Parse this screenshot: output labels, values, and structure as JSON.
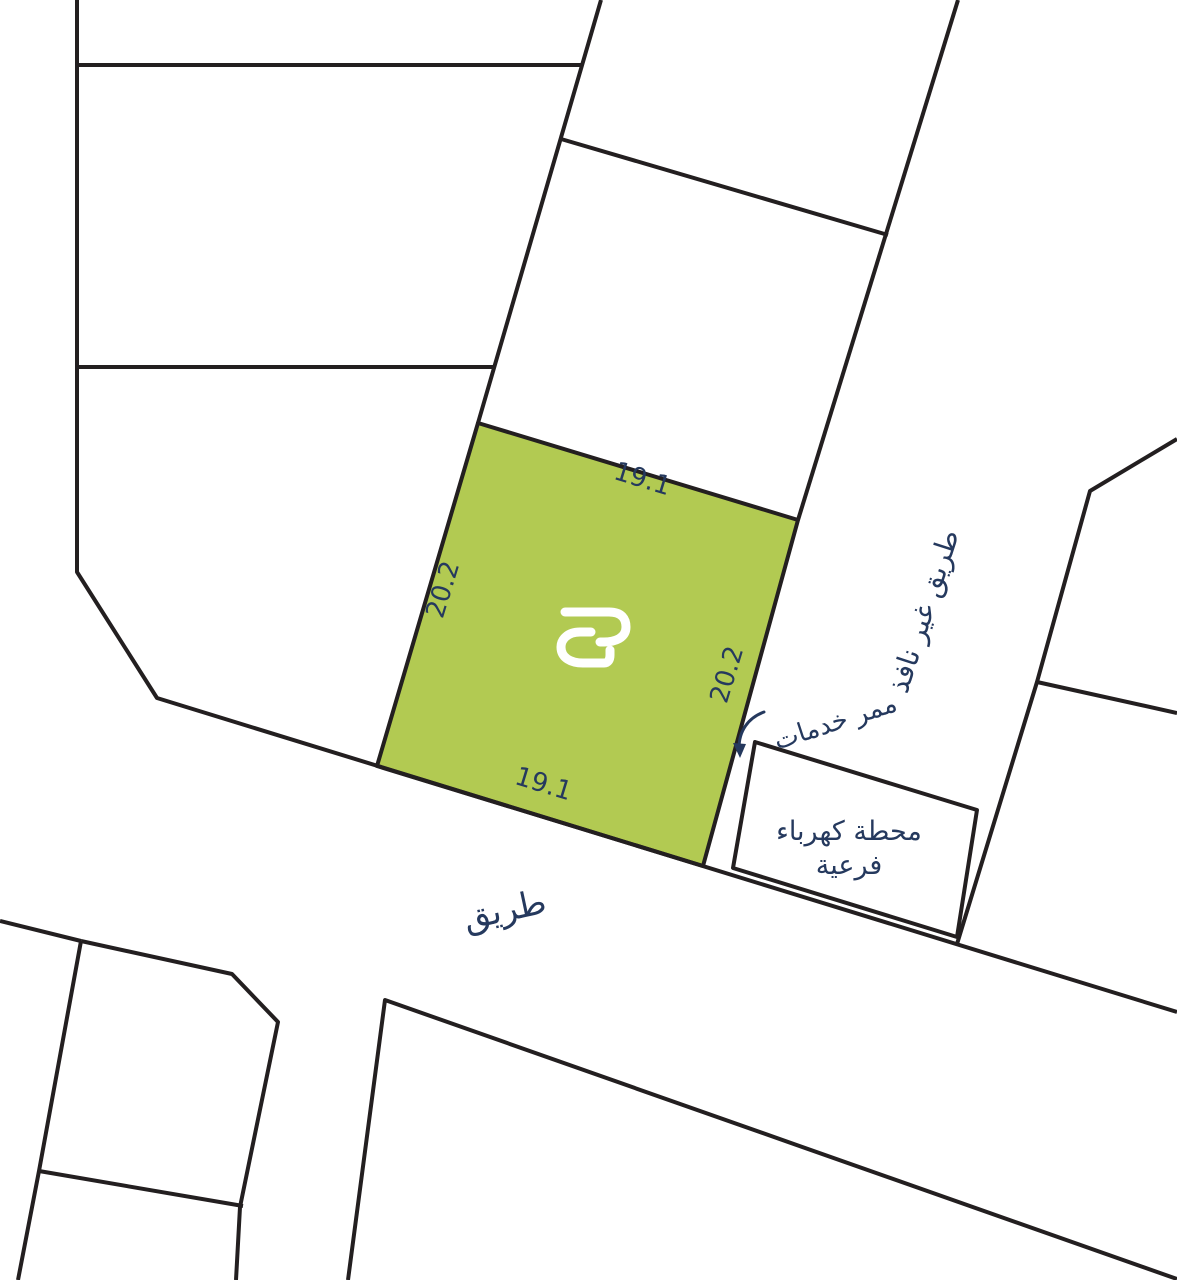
{
  "map": {
    "colors": {
      "background": "#ffffff",
      "line": "#231f20",
      "text": "#25395e",
      "plot_fill": "#b2ca52",
      "logo": "#ffffff"
    },
    "plot": {
      "dim_top": "19.1",
      "dim_bottom": "19.1",
      "dim_left": "20.2",
      "dim_right": "20.2"
    },
    "labels": {
      "road": "طريق",
      "dead_end_road": "طريق غير نافذ",
      "service_corridor": "ممر خدمات",
      "substation_line1": "محطة كهرباء",
      "substation_line2": "فرعية"
    }
  }
}
